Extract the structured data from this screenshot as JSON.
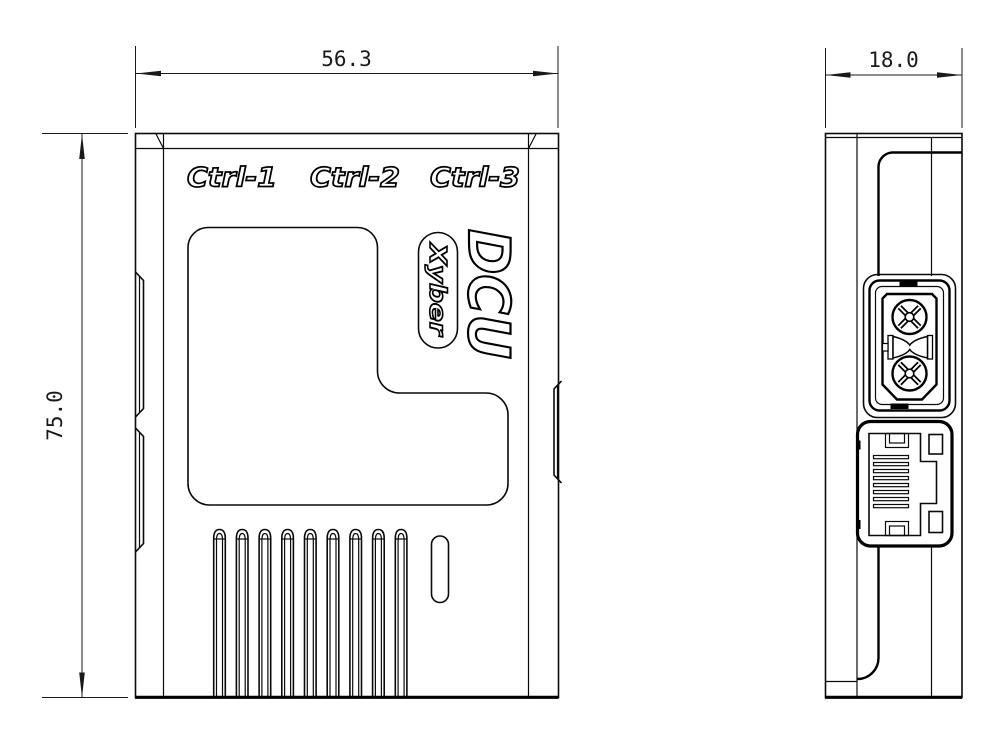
{
  "drawing": {
    "background_color": "#ffffff",
    "line_color": "#000000",
    "views": {
      "front": {
        "labels": {
          "ctrl1": "Ctrl-1",
          "ctrl2": "Ctrl-2",
          "ctrl3": "Ctrl-3",
          "product": "DCU",
          "brand": "Xyber"
        },
        "width_dim": "56.3",
        "height_dim": "75.0",
        "vent_slot_count": 9
      },
      "side": {
        "depth_dim": "18.0"
      }
    }
  }
}
